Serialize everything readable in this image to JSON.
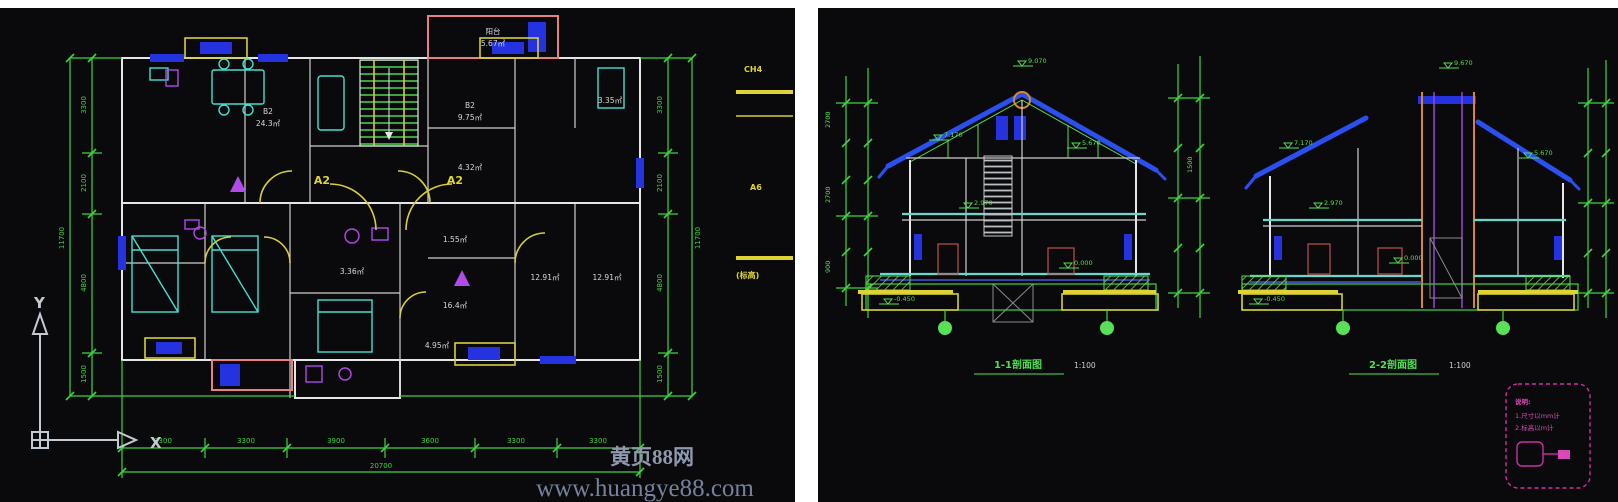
{
  "watermark": {
    "brand": "黄页88网",
    "url": "www.huangye88.com"
  },
  "colors": {
    "background": "#0a0a0c",
    "dimension_green": "#3fd43f",
    "bright_green": "#52e052",
    "wall_white": "#e6e6e6",
    "furniture_cyan": "#45e0d0",
    "slab_cyan": "#66d8cc",
    "fixture_purple": "#b04ae8",
    "door_yellow": "#d6cf3a",
    "window_blue": "#2432e0",
    "roof_blue": "#2a50f0",
    "balcony_pink": "#e88080",
    "chimney_orange": "#d8882a",
    "note_magenta": "#cc2fa0",
    "ucs_gray": "#c4cad2",
    "watermark_gray": "#76819b"
  },
  "floor_plan": {
    "axis_marker_left": "A2",
    "axis_marker_right": "A2",
    "ucs": {
      "x": "X",
      "y": "Y"
    },
    "balcony": {
      "name": "阳台",
      "area": "5.67㎡"
    },
    "rooms": [
      {
        "label": "B2",
        "area": "24.3㎡"
      },
      {
        "label": "B2",
        "area": "9.75㎡"
      },
      {
        "label": "",
        "area": "4.32㎡"
      },
      {
        "label": "",
        "area": "3.35㎡"
      },
      {
        "label": "",
        "area": "1.55㎡"
      },
      {
        "label": "",
        "area": "3.36㎡"
      },
      {
        "label": "",
        "area": "12.91㎡"
      },
      {
        "label": "",
        "area": "12.91㎡"
      },
      {
        "label": "",
        "area": "16.4㎡"
      },
      {
        "label": "",
        "area": "4.95㎡"
      }
    ],
    "dims": {
      "bottom": [
        "3300",
        "3300",
        "3900",
        "3600",
        "3300",
        "3300"
      ],
      "bottom_total": "20700",
      "left": [
        "3300",
        "2100",
        "4800",
        "1500"
      ],
      "left_total": "11700",
      "right": [
        "3300",
        "2100",
        "4800",
        "1500"
      ],
      "right_total": "11700"
    },
    "edge_notes": [
      "CH4",
      "A6",
      "(标高)"
    ]
  },
  "sections": {
    "left": {
      "title": "1-1剖面图",
      "scale": "1:100",
      "elevations": [
        "9.070",
        "7.170",
        "5.670",
        "2.970",
        "0.000",
        "-0.450"
      ]
    },
    "right": {
      "title": "2-2剖面图",
      "scale": "1:100",
      "elevations": [
        "9.670",
        "7.170",
        "5.670",
        "2.970",
        "0.000",
        "-0.450"
      ]
    },
    "stack_values": [
      "2700",
      "2700",
      "900",
      "1500"
    ],
    "notes": {
      "title": "说明:",
      "lines": [
        "1.尺寸以mm计",
        "2.标高以m计"
      ]
    }
  }
}
